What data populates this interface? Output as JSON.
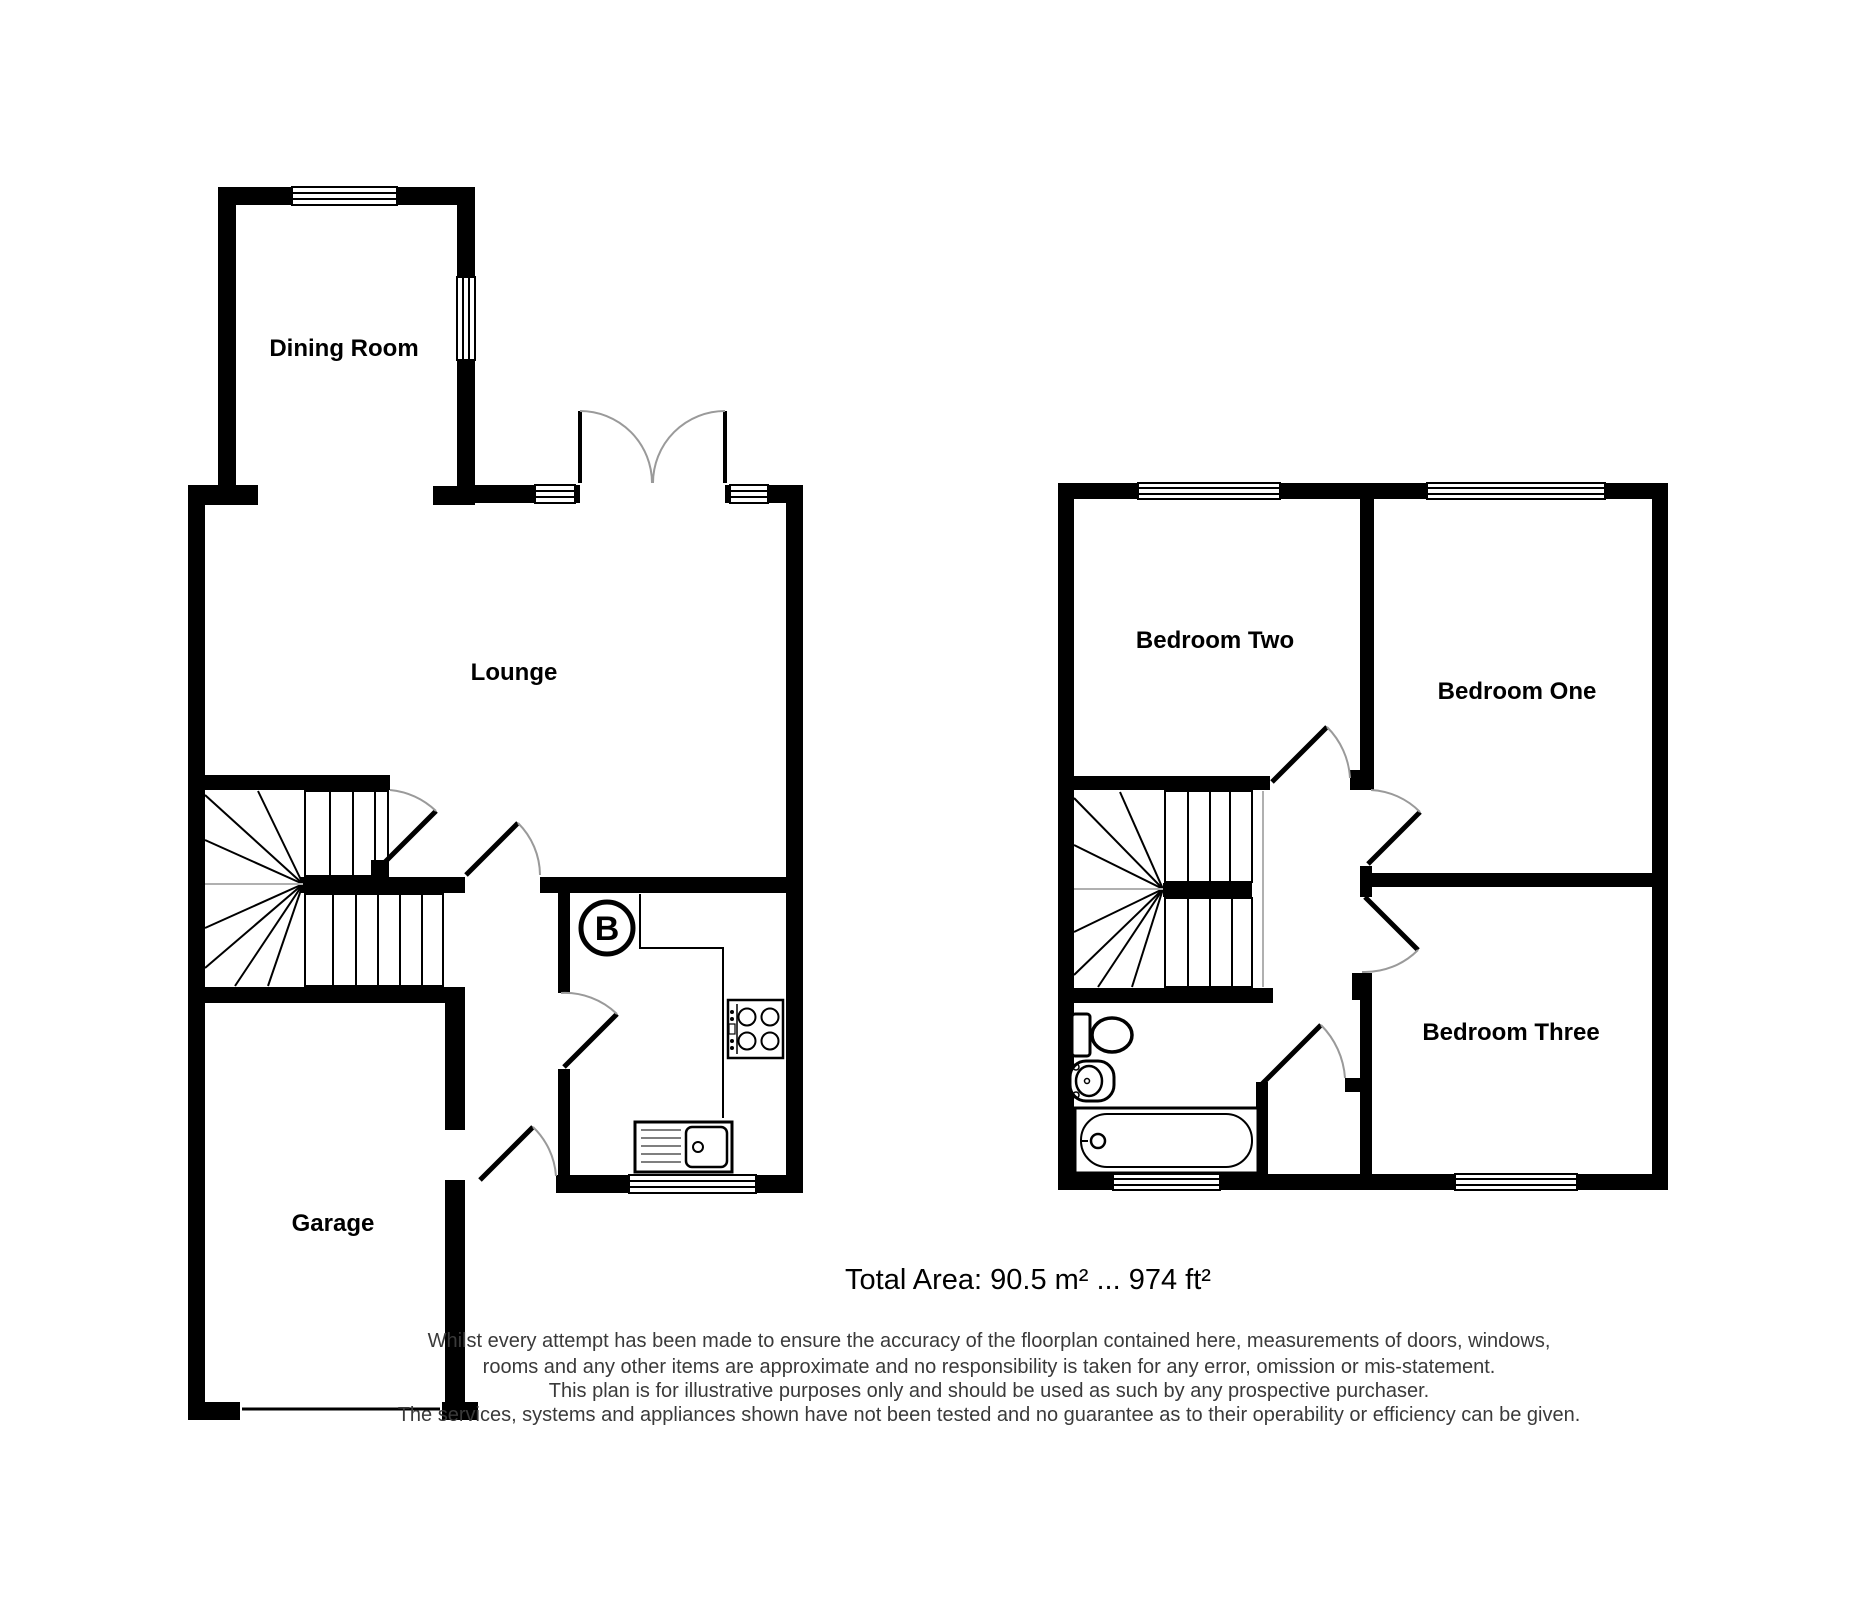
{
  "rooms": {
    "dining_room": "Dining Room",
    "lounge": "Lounge",
    "garage": "Garage",
    "bedroom_two": "Bedroom Two",
    "bedroom_one": "Bedroom One",
    "bedroom_three": "Bedroom Three"
  },
  "boiler": "B",
  "total_area": "Total Area: 90.5 m² ... 974 ft²",
  "disclaimer": {
    "line1": "Whilst every attempt has been made to ensure the accuracy of the floorplan contained here, measurements of doors, windows,",
    "line2": "rooms and any other items are approximate and no responsibility is taken for any error, omission or mis-statement.",
    "line3": "This plan is for illustrative purposes only and should be used as such by any prospective purchaser.",
    "line4": "The services, systems and appliances shown have not been tested and no guarantee as to their operability or efficiency can be given."
  },
  "colors": {
    "wall": "#000000",
    "door_arc": "#9a9a9a",
    "label": "#000000",
    "disclaimer": "#3a3a3a",
    "background": "#ffffff"
  }
}
